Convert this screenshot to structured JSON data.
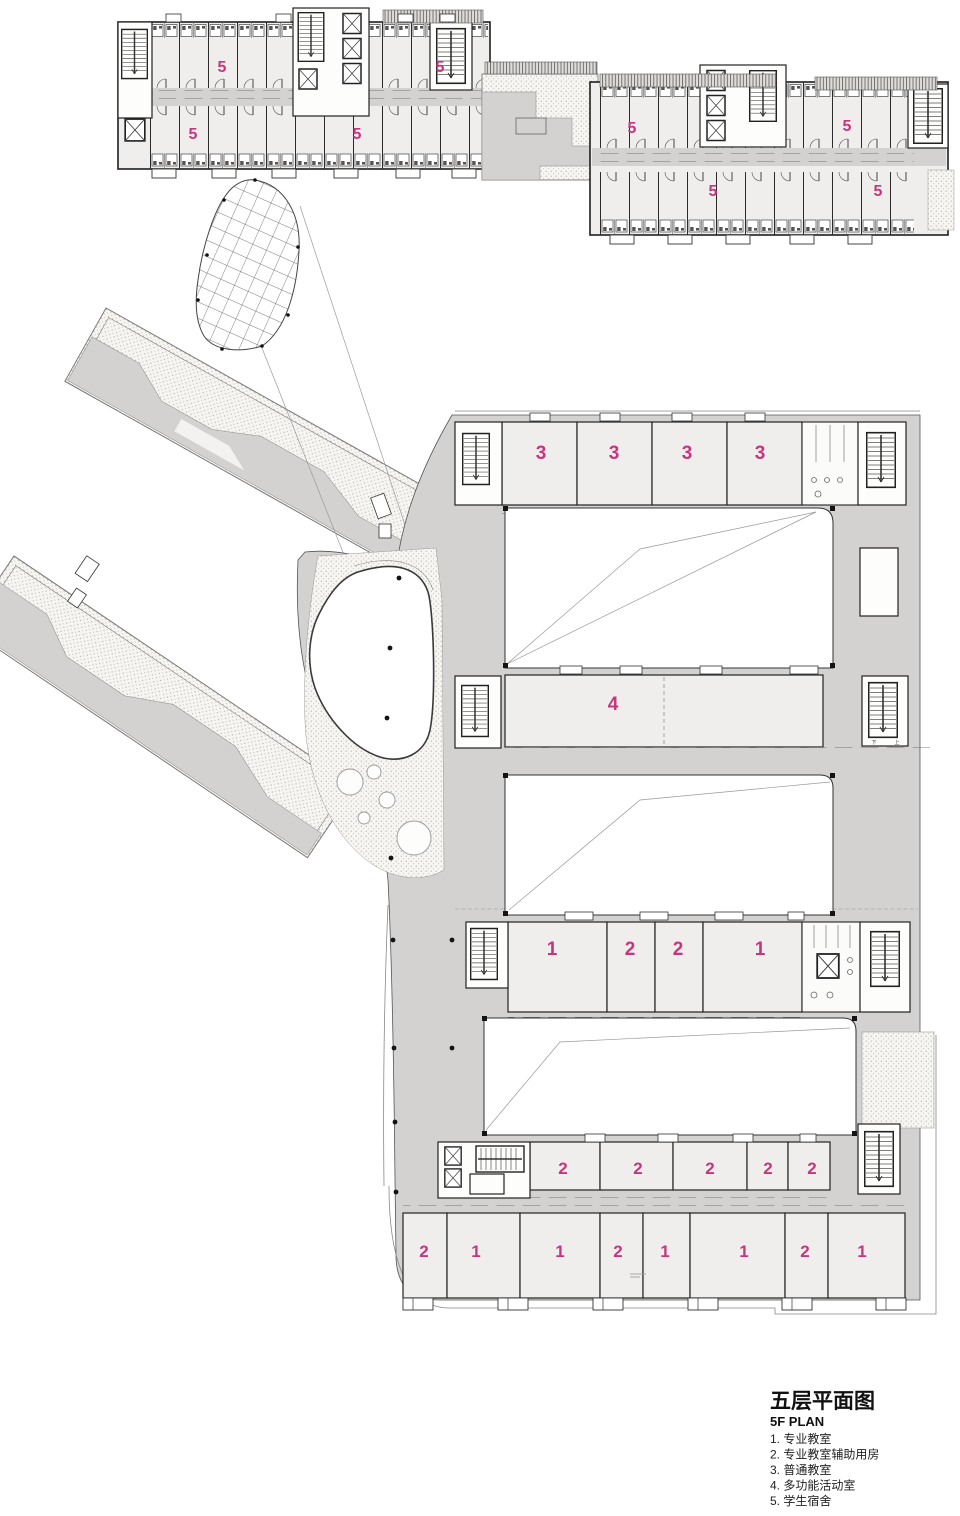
{
  "meta": {
    "accent_color": "#c5377c",
    "circulation_gray": "#d3d2d0",
    "room_fill": "#efeeec",
    "wall_color": "#1f1f1f"
  },
  "legend": {
    "title_zh": "五层平面图",
    "title_en": "5F PLAN",
    "items": [
      "1. 专业教室",
      "2. 专业教室辅助用房",
      "3. 普通教室",
      "4. 多功能活动室",
      "5. 学生宿舍"
    ]
  },
  "plan": {
    "dorm": [
      "5",
      "5",
      "5",
      "5",
      "5",
      "5",
      "5",
      "5"
    ],
    "row3": [
      "3",
      "3",
      "3",
      "3"
    ],
    "row4": [
      "4"
    ],
    "row12": [
      "1",
      "2",
      "2",
      "1"
    ],
    "row2s": [
      "2",
      "2",
      "2",
      "2",
      "2"
    ],
    "rowBottom": [
      "2",
      "1",
      "1",
      "2",
      "1",
      "1",
      "2",
      "1"
    ],
    "stair_up": "上",
    "stair_down": "下"
  }
}
